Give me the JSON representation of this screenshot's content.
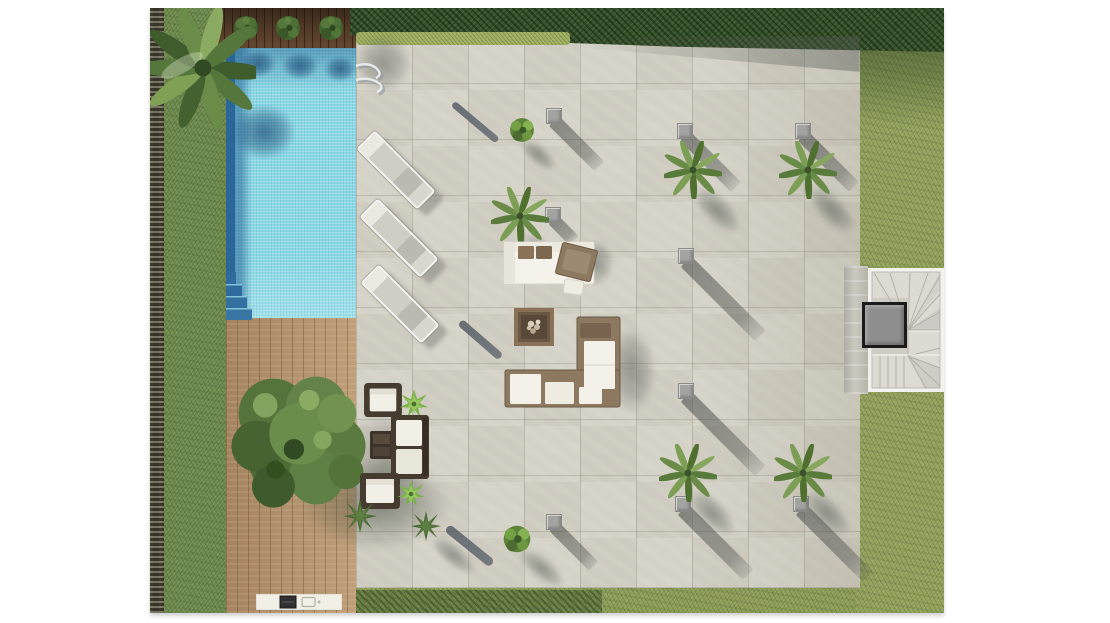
{
  "meta": {
    "title": "Villa exterior site plan - top view rendering",
    "description": "Aerial architectural rendering of a garden: lap pool with deck, stone tile patio with palms, lounge furniture, fire table, stairwell, lawn and gravel border. No visible text labels.",
    "palette": {
      "pool_water": "#8ed8e4",
      "pool_deep": "#2a6697",
      "deck_wood": "#b5926c",
      "deck_dark_wood": "#4e3827",
      "patio_stone": "#d5d2c7",
      "grass_left": "#6b874b",
      "grass_right": "#92a05b",
      "hedge": "#35502a",
      "gravel": "#4c463b",
      "cube_gray": "#a3a3a1",
      "sofa_frame": "#8d7860",
      "cushion_white": "#f3f1e9",
      "stair_shaft": "#8e8e8e",
      "background": "#ffffff"
    }
  },
  "scene": {
    "layers": [
      {
        "type": "gravel-strip",
        "name": "gravel-border-strip",
        "x": 0,
        "y": 0,
        "w": 16,
        "h": 605
      },
      {
        "type": "grass-left",
        "name": "lawn-left-band",
        "x": 14,
        "y": 0,
        "w": 64,
        "h": 605
      },
      {
        "type": "grass-top",
        "name": "lawn-top-band",
        "x": 200,
        "y": 0,
        "w": 594,
        "h": 46
      },
      {
        "type": "grass-right",
        "name": "lawn-right-band",
        "x": 706,
        "y": 0,
        "w": 88,
        "h": 605
      },
      {
        "type": "grass-shade-right",
        "name": "hedge-shadow-on-lawn",
        "x": 706,
        "y": 6,
        "w": 88,
        "h": 112
      },
      {
        "type": "deck-dark",
        "name": "planter-deck-strip",
        "x": 66,
        "y": 0,
        "w": 142,
        "h": 42
      },
      {
        "type": "pool",
        "name": "swimming-pool",
        "x": 76,
        "y": 40,
        "w": 130,
        "h": 272
      },
      {
        "type": "deck",
        "name": "wood-deck",
        "x": 76,
        "y": 310,
        "w": 132,
        "h": 295
      },
      {
        "type": "patio",
        "name": "stone-tile-patio",
        "x": 206,
        "y": 26,
        "w": 504,
        "h": 554
      },
      {
        "type": "patio-tint",
        "name": "patio-right-shading",
        "x": 555,
        "y": 26,
        "w": 155,
        "h": 554
      },
      {
        "type": "hedge-top",
        "name": "top-hedge",
        "x": 200,
        "y": 0,
        "w": 594,
        "h": 44
      },
      {
        "type": "hedge-light",
        "name": "light-hedge-row",
        "x": 206,
        "y": 24,
        "w": 214,
        "h": 13
      },
      {
        "type": "hedge-shade",
        "name": "hedge-shadow-on-patio",
        "x": 425,
        "y": 28,
        "w": 285,
        "h": 36
      },
      {
        "type": "grass-strip-bottom",
        "name": "lawn-bottom-strip",
        "x": 206,
        "y": 580,
        "w": 500,
        "h": 25
      },
      {
        "type": "hedge-bottom",
        "name": "bottom-hedge-strip",
        "x": 206,
        "y": 582,
        "w": 246,
        "h": 23
      },
      {
        "type": "stair-concrete",
        "name": "stair-landing-strip",
        "x": 694,
        "y": 258,
        "w": 24,
        "h": 128
      },
      {
        "type": "stairs",
        "name": "exterior-staircase",
        "x": 718,
        "y": 260,
        "w": 76,
        "h": 124
      },
      {
        "type": "stair-core",
        "name": "stair-shaft",
        "x": 712,
        "y": 294,
        "w": 45,
        "h": 46
      },
      {
        "type": "pool-shadow",
        "name": "bush-shadow-on-pool",
        "x": 90,
        "y": 42,
        "w": 36,
        "h": 28
      },
      {
        "type": "pool-shadow",
        "name": "bush-shadow-on-pool",
        "x": 132,
        "y": 44,
        "w": 36,
        "h": 28
      },
      {
        "type": "pool-shadow",
        "name": "bush-shadow-on-pool",
        "x": 174,
        "y": 48,
        "w": 32,
        "h": 26
      },
      {
        "type": "pool-shadow",
        "name": "palm-shadow-on-pool",
        "x": 82,
        "y": 96,
        "w": 64,
        "h": 56
      },
      {
        "type": "pool-steps",
        "name": "pool-steps",
        "x": 76,
        "y": 264,
        "w": 26,
        "h": 48
      },
      {
        "type": "shadow-gray",
        "name": "palm-shadow-patio-corner",
        "x": 204,
        "y": 26,
        "w": 58,
        "h": 58
      },
      {
        "type": "ladder",
        "name": "pool-ladder",
        "x": 198,
        "y": 50,
        "w": 44,
        "h": 40
      },
      {
        "type": "streak",
        "name": "pole-shadow",
        "x": 303,
        "y": 92,
        "w": 58,
        "h": 7,
        "rot": 40
      },
      {
        "type": "streak",
        "name": "pole-shadow",
        "x": 310,
        "y": 310,
        "w": 54,
        "h": 8,
        "rot": 41
      },
      {
        "type": "streak",
        "name": "pole-shadow",
        "x": 297,
        "y": 515,
        "w": 58,
        "h": 9,
        "rot": 39
      },
      {
        "type": "cube-shadow",
        "name": "cube-shadow",
        "x": 404,
        "y": 106,
        "w": 64,
        "h": 14,
        "rot": 45
      },
      {
        "type": "cube-shadow",
        "name": "cube-shadow",
        "x": 535,
        "y": 121,
        "w": 72,
        "h": 14,
        "rot": 45
      },
      {
        "type": "cube-shadow",
        "name": "cube-shadow",
        "x": 653,
        "y": 121,
        "w": 72,
        "h": 14,
        "rot": 45
      },
      {
        "type": "cube-shadow",
        "name": "cube-shadow",
        "x": 403,
        "y": 205,
        "w": 30,
        "h": 13,
        "rot": 45
      },
      {
        "type": "cube-shadow",
        "name": "cube-shadow",
        "x": 536,
        "y": 246,
        "w": 105,
        "h": 15,
        "rot": 45
      },
      {
        "type": "cube-shadow",
        "name": "cube-shadow",
        "x": 536,
        "y": 381,
        "w": 105,
        "h": 15,
        "rot": 45
      },
      {
        "type": "cube-shadow",
        "name": "cube-shadow",
        "x": 533,
        "y": 494,
        "w": 92,
        "h": 15,
        "rot": 45
      },
      {
        "type": "cube-shadow",
        "name": "cube-shadow",
        "x": 651,
        "y": 494,
        "w": 95,
        "h": 15,
        "rot": 45
      },
      {
        "type": "cube-shadow",
        "name": "cube-shadow",
        "x": 404,
        "y": 512,
        "w": 56,
        "h": 13,
        "rot": 45
      },
      {
        "type": "cube",
        "name": "light-cube",
        "x": 396,
        "y": 100,
        "w": 16,
        "h": 16
      },
      {
        "type": "cube",
        "name": "light-cube",
        "x": 527,
        "y": 115,
        "w": 16,
        "h": 16
      },
      {
        "type": "cube",
        "name": "light-cube",
        "x": 645,
        "y": 115,
        "w": 16,
        "h": 16
      },
      {
        "type": "cube",
        "name": "light-cube",
        "x": 395,
        "y": 199,
        "w": 16,
        "h": 16
      },
      {
        "type": "cube",
        "name": "light-cube",
        "x": 528,
        "y": 240,
        "w": 16,
        "h": 16
      },
      {
        "type": "cube",
        "name": "light-cube",
        "x": 528,
        "y": 375,
        "w": 16,
        "h": 16
      },
      {
        "type": "cube",
        "name": "light-cube",
        "x": 525,
        "y": 488,
        "w": 16,
        "h": 16
      },
      {
        "type": "cube",
        "name": "light-cube",
        "x": 643,
        "y": 488,
        "w": 16,
        "h": 16
      },
      {
        "type": "cube",
        "name": "light-cube",
        "x": 396,
        "y": 506,
        "w": 16,
        "h": 16
      },
      {
        "type": "frond-shadow",
        "name": "palm-shadow",
        "x": 372,
        "y": 212,
        "w": 62,
        "h": 28,
        "rot": 45
      },
      {
        "type": "frond-shadow",
        "name": "palm-shadow",
        "x": 545,
        "y": 166,
        "w": 62,
        "h": 28,
        "rot": 45
      },
      {
        "type": "frond-shadow",
        "name": "palm-shadow",
        "x": 660,
        "y": 166,
        "w": 62,
        "h": 28,
        "rot": 45
      },
      {
        "type": "frond-shadow",
        "name": "palm-shadow",
        "x": 540,
        "y": 469,
        "w": 62,
        "h": 28,
        "rot": 45
      },
      {
        "type": "frond-shadow",
        "name": "palm-shadow",
        "x": 655,
        "y": 469,
        "w": 62,
        "h": 28,
        "rot": 45
      },
      {
        "type": "frond-shadow",
        "name": "bush-shadow",
        "x": 372,
        "y": 122,
        "w": 44,
        "h": 20,
        "rot": 42
      },
      {
        "type": "frond-shadow",
        "name": "bush-shadow",
        "x": 370,
        "y": 530,
        "w": 56,
        "h": 24,
        "rot": 40
      },
      {
        "type": "frond-shadow",
        "name": "agave-shadow",
        "x": 282,
        "y": 518,
        "w": 56,
        "h": 22,
        "rot": 40
      },
      {
        "type": "palm",
        "name": "patio-palm-tree",
        "x": 341,
        "y": 179,
        "w": 58,
        "h": 58
      },
      {
        "type": "palm",
        "name": "patio-palm-tree",
        "x": 514,
        "y": 133,
        "w": 58,
        "h": 58
      },
      {
        "type": "palm",
        "name": "patio-palm-tree",
        "x": 629,
        "y": 133,
        "w": 58,
        "h": 58
      },
      {
        "type": "palm",
        "name": "patio-palm-tree",
        "x": 509,
        "y": 436,
        "w": 58,
        "h": 58
      },
      {
        "type": "palm",
        "name": "patio-palm-tree",
        "x": 624,
        "y": 436,
        "w": 58,
        "h": 58
      },
      {
        "type": "plant-bush",
        "name": "patio-bush",
        "x": 355,
        "y": 104,
        "w": 34,
        "h": 36
      },
      {
        "type": "plant-bush",
        "name": "patio-bush",
        "x": 348,
        "y": 512,
        "w": 38,
        "h": 38
      },
      {
        "type": "lounger-shadow",
        "name": "lounger-shadow",
        "x": 242,
        "y": 126,
        "w": 26,
        "h": 86,
        "rot": -45
      },
      {
        "type": "lounger-shadow",
        "name": "lounger-shadow",
        "x": 245,
        "y": 194,
        "w": 26,
        "h": 86,
        "rot": -45
      },
      {
        "type": "lounger-shadow",
        "name": "lounger-shadow",
        "x": 246,
        "y": 260,
        "w": 26,
        "h": 86,
        "rot": -45
      },
      {
        "type": "lounger",
        "name": "sun-lounger",
        "x": 233,
        "y": 119,
        "w": 26,
        "h": 86,
        "rot": -45
      },
      {
        "type": "lounger",
        "name": "sun-lounger",
        "x": 236,
        "y": 187,
        "w": 26,
        "h": 86,
        "rot": -45
      },
      {
        "type": "lounger",
        "name": "sun-lounger",
        "x": 237,
        "y": 253,
        "w": 26,
        "h": 86,
        "rot": -45
      },
      {
        "type": "shadow-gray",
        "name": "sofa-shadow",
        "x": 428,
        "y": 232,
        "w": 36,
        "h": 46
      },
      {
        "type": "shadow-gray",
        "name": "sofa-shadow",
        "x": 458,
        "y": 320,
        "w": 48,
        "h": 86
      },
      {
        "type": "sofa-upper",
        "name": "outdoor-sofa-set-upper",
        "x": 348,
        "y": 228,
        "w": 130,
        "h": 70
      },
      {
        "type": "sofa-lower",
        "name": "outdoor-sofa-set-lower",
        "x": 353,
        "y": 306,
        "w": 120,
        "h": 100
      },
      {
        "type": "fire-table",
        "name": "fire-pit-table",
        "x": 364,
        "y": 300,
        "w": 40,
        "h": 38
      },
      {
        "type": "tree-shadow",
        "name": "tree-shadow",
        "x": 150,
        "y": 450,
        "w": 150,
        "h": 92
      },
      {
        "type": "shadow-soft",
        "name": "seating-set-shadow",
        "x": 196,
        "y": 396,
        "w": 82,
        "h": 128
      },
      {
        "type": "tree",
        "name": "large-garden-tree",
        "x": 62,
        "y": 344,
        "w": 174,
        "h": 174
      },
      {
        "type": "armchair",
        "name": "wicker-armchair",
        "x": 212,
        "y": 374,
        "w": 42,
        "h": 36
      },
      {
        "type": "plant-bright",
        "name": "deck-plant",
        "x": 248,
        "y": 379,
        "w": 32,
        "h": 34
      },
      {
        "type": "side-table",
        "name": "side-table",
        "x": 219,
        "y": 422,
        "w": 25,
        "h": 30
      },
      {
        "type": "sofa-small",
        "name": "wicker-sofa",
        "x": 240,
        "y": 406,
        "w": 40,
        "h": 66
      },
      {
        "type": "armchair",
        "name": "wicker-armchair",
        "x": 209,
        "y": 464,
        "w": 42,
        "h": 38
      },
      {
        "type": "plant-bright",
        "name": "deck-plant",
        "x": 246,
        "y": 469,
        "w": 30,
        "h": 34
      },
      {
        "type": "agave",
        "name": "agave-plant",
        "x": 192,
        "y": 490,
        "w": 36,
        "h": 36
      },
      {
        "type": "agave",
        "name": "agave-plant",
        "x": 260,
        "y": 502,
        "w": 32,
        "h": 32
      },
      {
        "type": "grill",
        "name": "outdoor-kitchen-grill",
        "x": 106,
        "y": 586,
        "w": 86,
        "h": 16
      },
      {
        "type": "bush",
        "name": "planter-bush",
        "x": 81,
        "y": 5,
        "w": 30,
        "h": 30
      },
      {
        "type": "bush",
        "name": "planter-bush",
        "x": 123,
        "y": 5,
        "w": 30,
        "h": 30
      },
      {
        "type": "bush",
        "name": "planter-bush",
        "x": 166,
        "y": 5,
        "w": 30,
        "h": 30
      },
      {
        "type": "palm-big",
        "name": "corner-palm-tree",
        "x": 0,
        "y": 0,
        "w": 106,
        "h": 120
      }
    ]
  }
}
